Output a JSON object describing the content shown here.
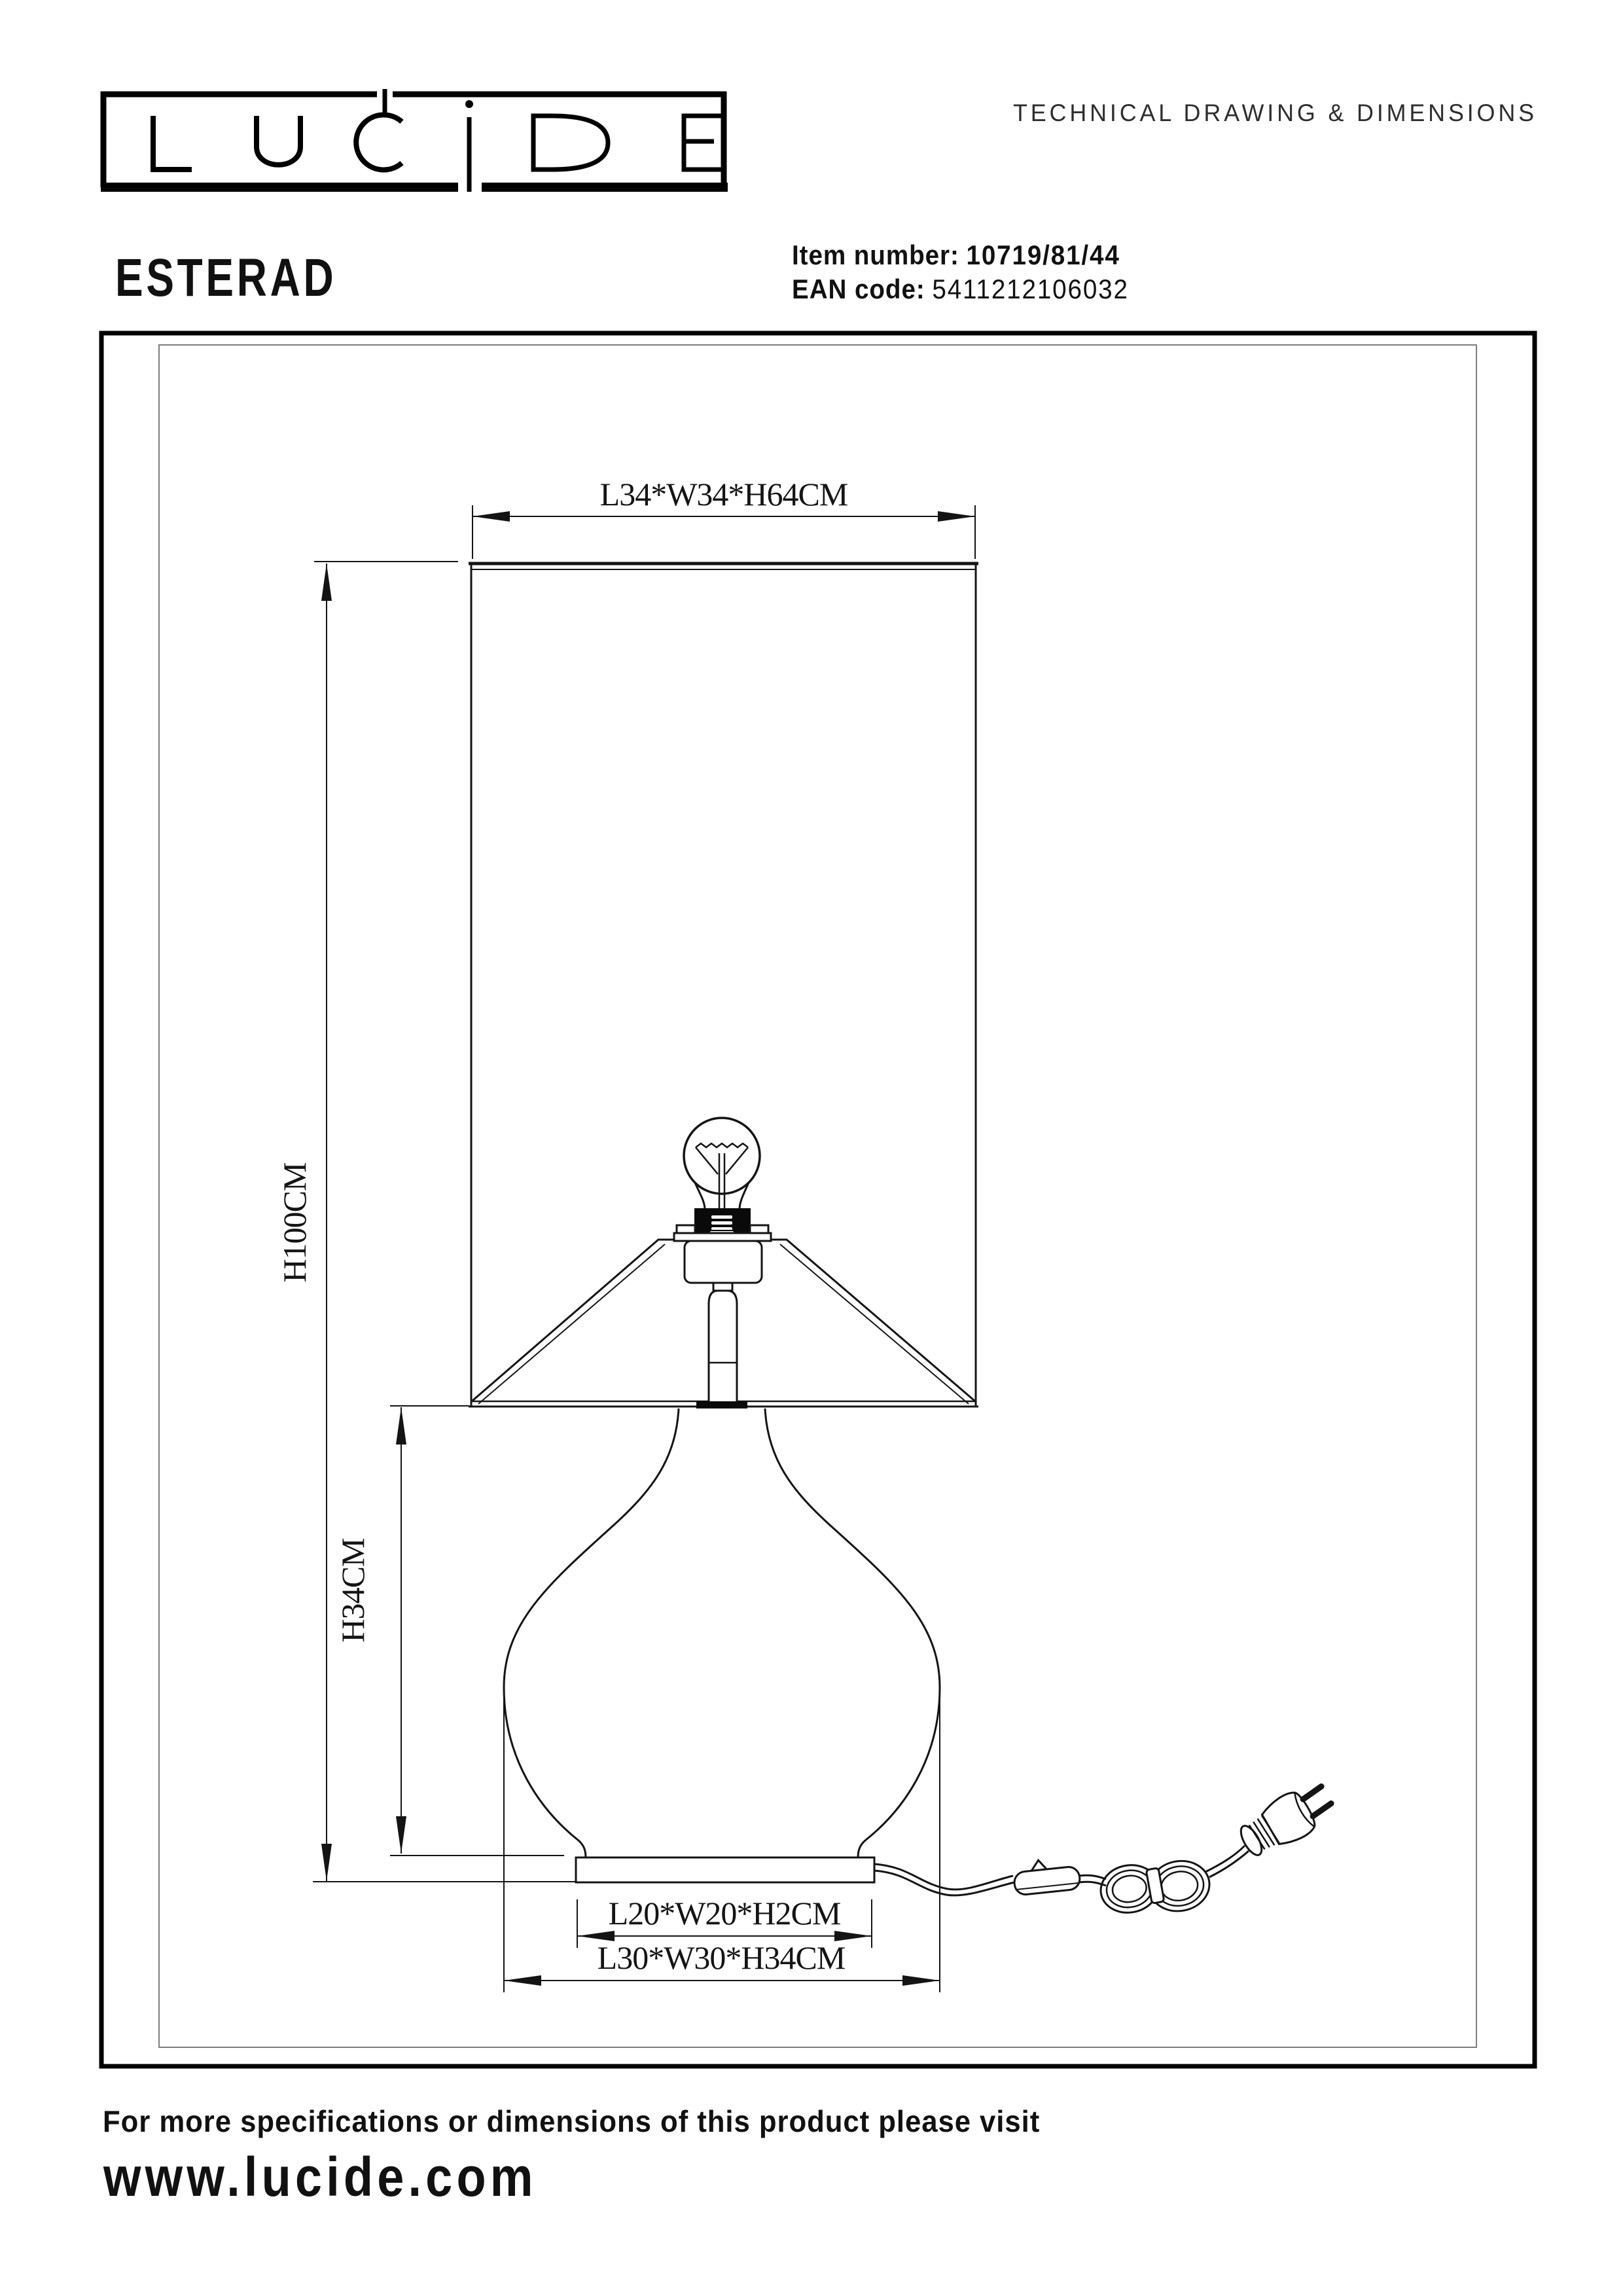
{
  "header": {
    "brand": "LUCIDE",
    "doc_title": "TECHNICAL DRAWING & DIMENSIONS",
    "product_name": "ESTERAD",
    "item_number_label": "Item number:",
    "item_number_value": "10719/81/44",
    "ean_label": "EAN code:",
    "ean_value": "5411212106032"
  },
  "drawing": {
    "dimensions": {
      "shade": "L34*W34*H64CM",
      "overall_height": "H100CM",
      "glass_body_height": "H34CM",
      "base_plate": "L20*W20*H2CM",
      "glass_body": "L30*W30*H34CM"
    },
    "colors": {
      "line": "#141414",
      "inner_frame": "#7d7d7d",
      "socket_fill": "#0a0a0a"
    }
  },
  "footer": {
    "note": "For more specifications or dimensions of this product please visit",
    "website": "www.lucide.com"
  }
}
